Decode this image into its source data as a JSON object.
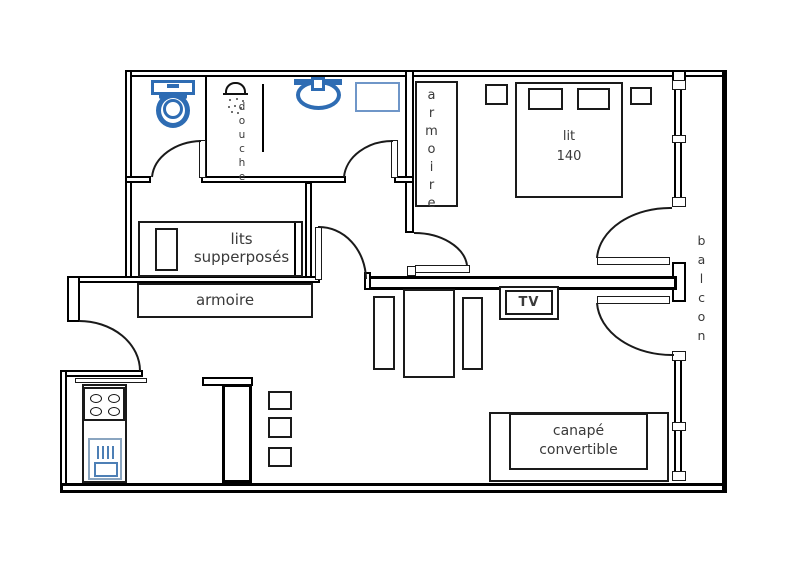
{
  "plan": {
    "rooms": {
      "bathroom": {
        "shower_label": "douche"
      },
      "bedroom": {
        "wardrobe_label": "armoire",
        "bed_label_line1": "lit",
        "bed_label_line2": "140"
      },
      "kids_room": {
        "bed_label_line1": "lits",
        "bed_label_line2": "supperposés",
        "wardrobe_label": "armoire"
      },
      "living_room": {
        "tv_label": "TV",
        "sofa_label_line1": "canapé",
        "sofa_label_line2": "convertible"
      },
      "balcony": {
        "label": "balcon"
      }
    },
    "colors": {
      "fixture_blue": "#2e6cb3",
      "appliance_blue": "#7f9db9",
      "line_black": "#111111",
      "text_gray": "#3a3a3a"
    }
  }
}
